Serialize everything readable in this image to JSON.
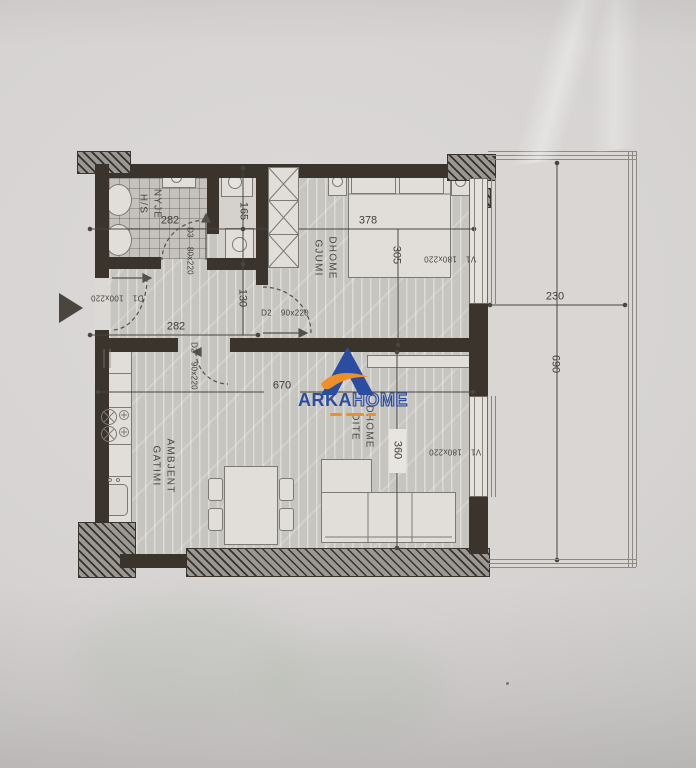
{
  "logo": {
    "brand_primary": "ARKA",
    "brand_secondary": "HOME",
    "blue": "#2b4da1",
    "orange": "#ee8f28"
  },
  "rooms": {
    "bathroom": {
      "line1": "NYJE",
      "line2": "H/S"
    },
    "bedroom": {
      "line1": "DHOME",
      "line2": "GJUMI"
    },
    "living": {
      "line1": "DHOME",
      "line2": "DITE"
    },
    "kitchen": {
      "line1": "AMBJENT",
      "line2": "GATIMI"
    }
  },
  "dimensions_cm": {
    "bathroom_width": "282",
    "corridor_width": "282",
    "bathroom_right_depth": "165",
    "corridor_depth": "130",
    "bedroom_width": "378",
    "bedroom_depth": "305",
    "living_width": "670",
    "living_depth": "360",
    "balcony_width": "230",
    "balcony_length": "690"
  },
  "openings": {
    "entrance_door": {
      "code": "D1",
      "size": "100x220"
    },
    "bathroom_door": {
      "code": "D3",
      "size": "80x220"
    },
    "bedroom_door": {
      "code": "D2",
      "size": "90x220"
    },
    "living_door": {
      "code": "D2",
      "size": "90x220"
    },
    "bedroom_window": {
      "code": "V1",
      "size": "180x220"
    },
    "living_window": {
      "code": "V1",
      "size": "180x220"
    }
  }
}
